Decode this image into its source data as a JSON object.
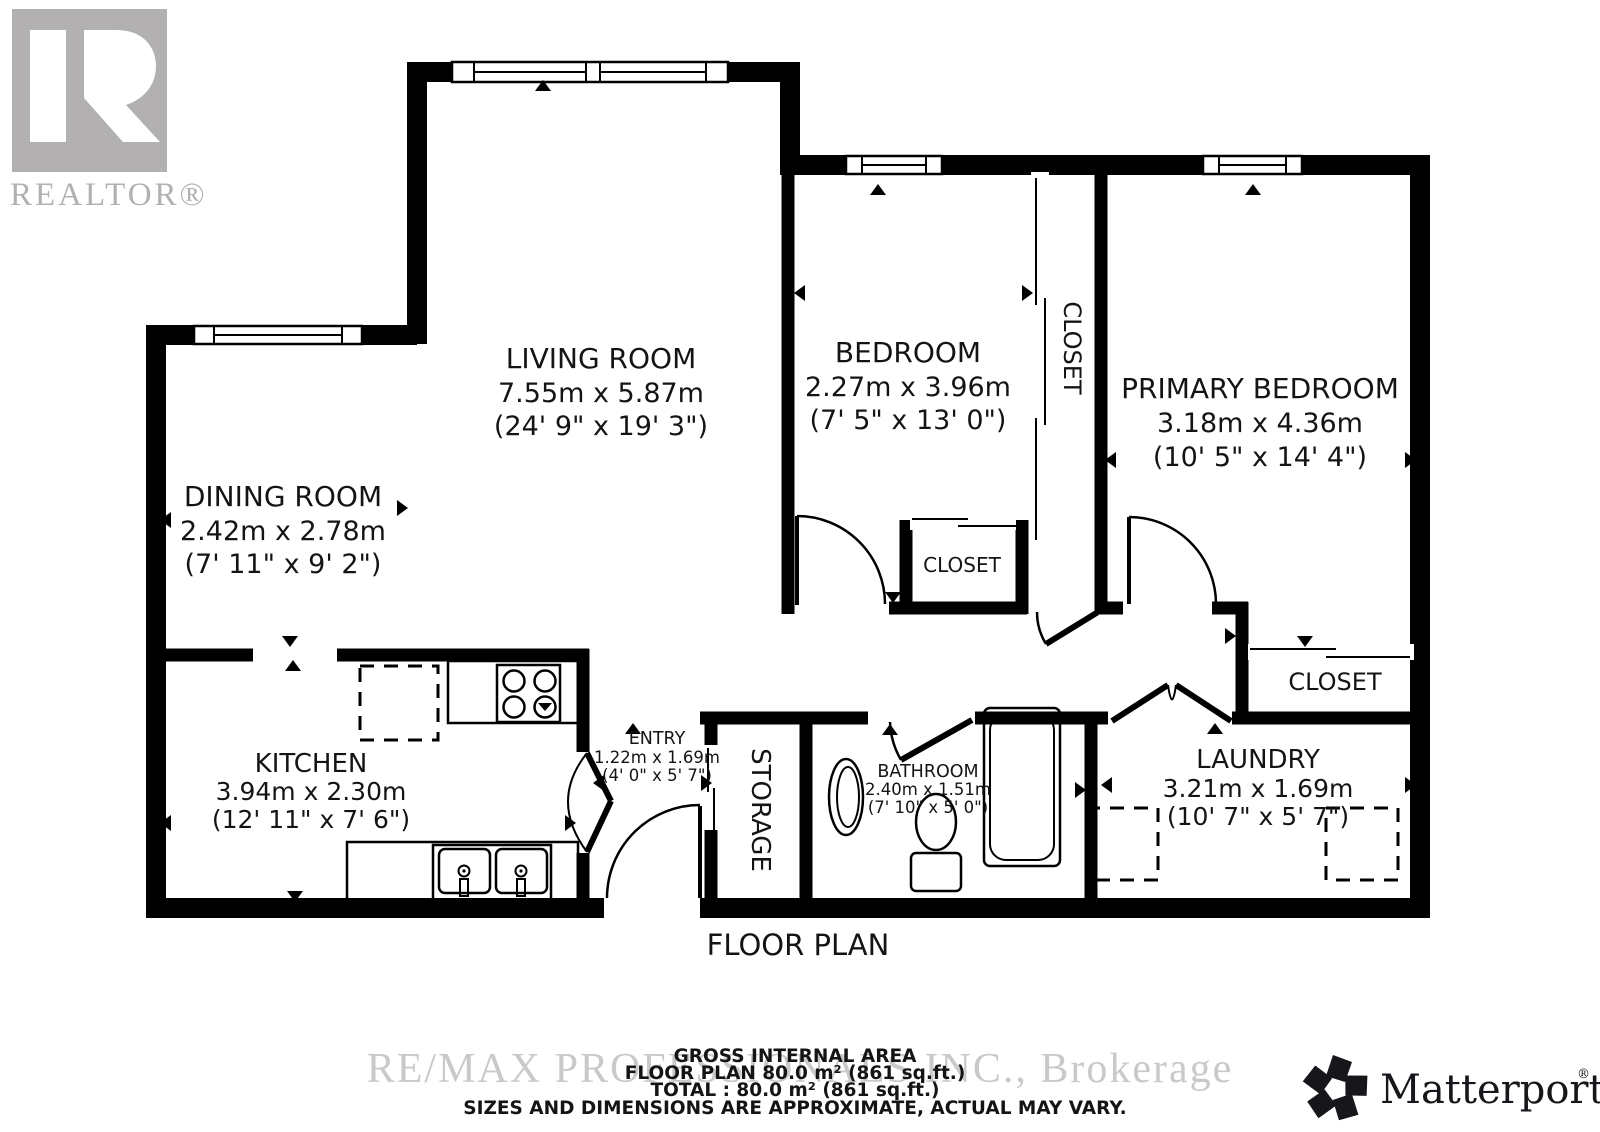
{
  "branding": {
    "realtor_logo_letter": "R",
    "realtor_logo_text": "REALTOR®",
    "watermark": "RE/MAX PROFESSIONALS INC., Brokerage",
    "matterport_text": "Matterport",
    "matterport_reg": "®"
  },
  "title": "FLOOR PLAN",
  "rooms": {
    "living": {
      "name": "LIVING ROOM",
      "metric": "7.55m x 5.87m",
      "imperial": "(24' 9\" x 19' 3\")"
    },
    "dining": {
      "name": "DINING ROOM",
      "metric": "2.42m x 2.78m",
      "imperial": "(7' 11\" x 9' 2\")"
    },
    "bedroom": {
      "name": "BEDROOM",
      "metric": "2.27m x 3.96m",
      "imperial": "(7' 5\" x 13' 0\")"
    },
    "primary": {
      "name": "PRIMARY BEDROOM",
      "metric": "3.18m x 4.36m",
      "imperial": "(10' 5\" x 14' 4\")"
    },
    "kitchen": {
      "name": "KITCHEN",
      "metric": "3.94m x 2.30m",
      "imperial": "(12' 11\" x 7' 6\")"
    },
    "entry": {
      "name": "ENTRY",
      "metric": "1.22m x 1.69m",
      "imperial": "(4' 0\" x 5' 7\")"
    },
    "bathroom": {
      "name": "BATHROOM",
      "metric": "2.40m x 1.51m",
      "imperial": "(7' 10\" x 5' 0\")"
    },
    "laundry": {
      "name": "LAUNDRY",
      "metric": "3.21m x 1.69m",
      "imperial": "(10' 7\" x 5' 7\")"
    },
    "storage": {
      "name": "STORAGE"
    },
    "closet_hall": {
      "name": "CLOSET"
    },
    "closet_bedroom": {
      "name": "CLOSET"
    },
    "closet_primary": {
      "name": "CLOSET"
    }
  },
  "footer": {
    "line1": "GROSS INTERNAL AREA",
    "line2": "FLOOR PLAN 80.0 m² (861 sq.ft.)",
    "line3": "TOTAL :  80.0 m² (861 sq.ft.)",
    "line4": "SIZES AND DIMENSIONS ARE APPROXIMATE, ACTUAL MAY VARY."
  }
}
